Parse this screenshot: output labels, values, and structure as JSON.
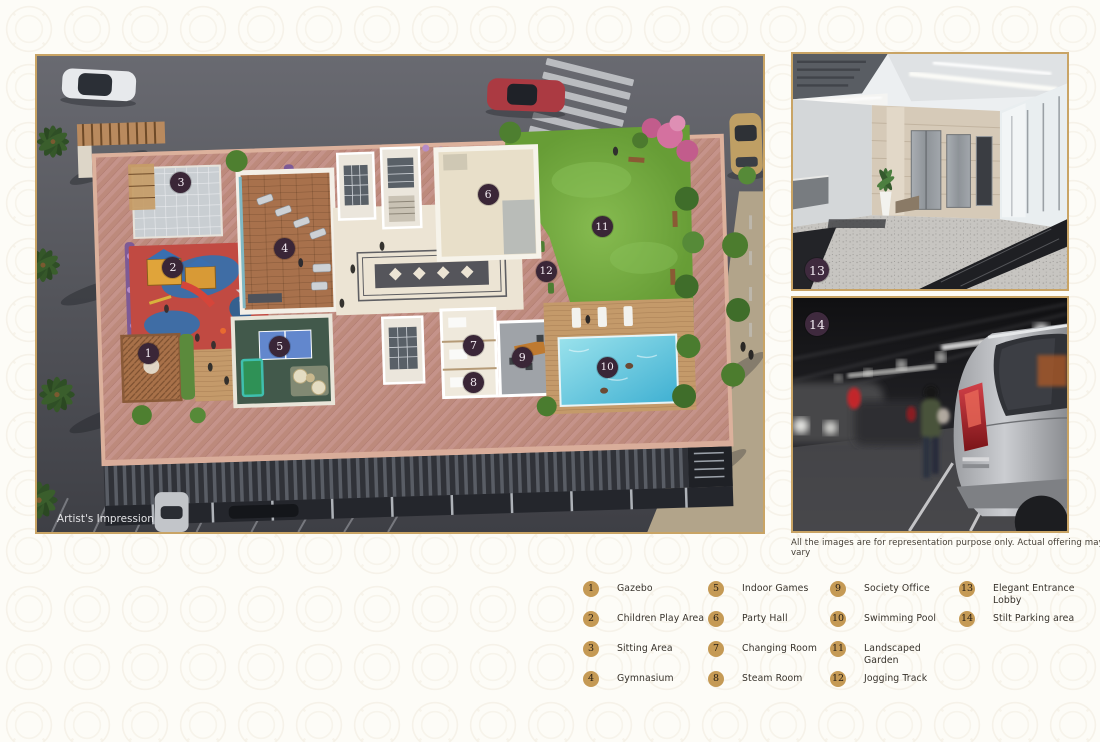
{
  "page": {
    "artists_impression": "Artist's Impression",
    "caption": "All the images are for representation purpose only. Actual offering may vary"
  },
  "colors": {
    "legend_badge_gold": "#c59a55",
    "plan_marker_plum": "#3a2637",
    "frame_gold": "#c9a465"
  },
  "plan": {
    "markers": [
      {
        "n": "1",
        "x": 15.4,
        "y": 62.6
      },
      {
        "n": "2",
        "x": 18.8,
        "y": 44.6
      },
      {
        "n": "3",
        "x": 19.9,
        "y": 26.6
      },
      {
        "n": "4",
        "x": 34.2,
        "y": 40.6
      },
      {
        "n": "5",
        "x": 33.5,
        "y": 61.1
      },
      {
        "n": "6",
        "x": 62.2,
        "y": 29.1
      },
      {
        "n": "7",
        "x": 60.2,
        "y": 60.9
      },
      {
        "n": "8",
        "x": 60.2,
        "y": 68.6
      },
      {
        "n": "9",
        "x": 66.9,
        "y": 63.4
      },
      {
        "n": "10",
        "x": 78.6,
        "y": 65.5
      },
      {
        "n": "11",
        "x": 77.9,
        "y": 36.0
      },
      {
        "n": "12",
        "x": 70.2,
        "y": 45.4
      }
    ]
  },
  "photos": {
    "lobby": {
      "marker": "13"
    },
    "parking": {
      "marker": "14"
    }
  },
  "legend": {
    "columns": [
      [
        {
          "n": "1",
          "label": "Gazebo"
        },
        {
          "n": "2",
          "label": "Children Play Area"
        },
        {
          "n": "3",
          "label": "Sitting Area"
        },
        {
          "n": "4",
          "label": "Gymnasium"
        }
      ],
      [
        {
          "n": "5",
          "label": "Indoor Games"
        },
        {
          "n": "6",
          "label": "Party Hall"
        },
        {
          "n": "7",
          "label": "Changing Room"
        },
        {
          "n": "8",
          "label": "Steam Room"
        }
      ],
      [
        {
          "n": "9",
          "label": "Society Office"
        },
        {
          "n": "10",
          "label": "Swimming Pool"
        },
        {
          "n": "11",
          "label": "Landscaped Garden"
        },
        {
          "n": "12",
          "label": "Jogging Track"
        }
      ],
      [
        {
          "n": "13",
          "label": "Elegant Entrance Lobby"
        },
        {
          "n": "14",
          "label": "Stilt Parking area"
        }
      ]
    ]
  }
}
